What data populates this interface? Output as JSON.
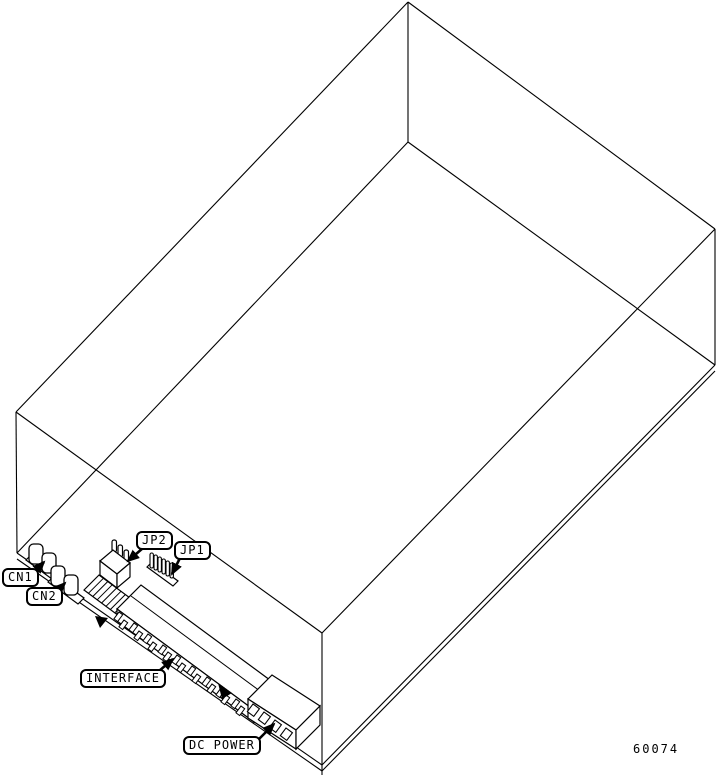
{
  "diagram": {
    "figure_number": "60074",
    "callouts": {
      "cn1": "CN1",
      "cn2": "CN2",
      "jp2": "JP2",
      "jp1": "JP1",
      "interface": "INTERFACE",
      "dc_power": "DC POWER"
    },
    "colors": {
      "ink": "#000000",
      "paper": "#ffffff"
    }
  }
}
